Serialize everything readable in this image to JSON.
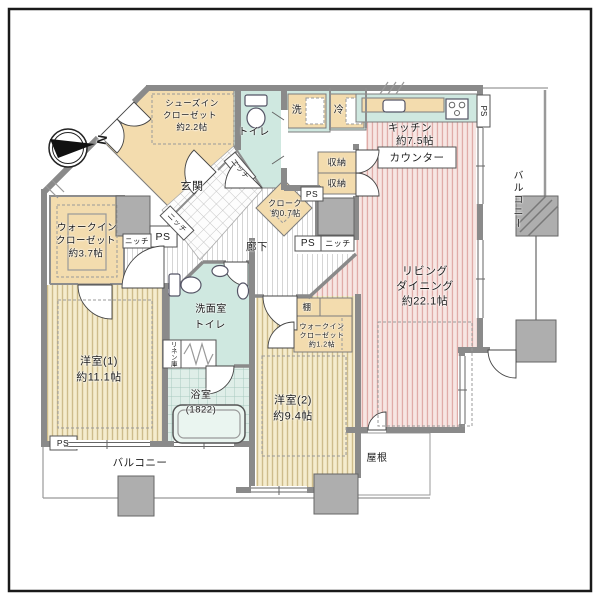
{
  "plan": {
    "compass_label": "N",
    "entrance": {
      "label": "玄関"
    },
    "corridor": {
      "label": "廊下"
    },
    "shoe_closet": {
      "line1": "シューズイン",
      "line2": "クローゼット",
      "line3": "約2.2帖"
    },
    "toilet_top": {
      "label": "トイレ"
    },
    "laundry": {
      "label": "洗"
    },
    "fridge": {
      "label": "冷"
    },
    "kitchen": {
      "line1": "キッチン",
      "line2": "約7.5帖",
      "counter": "カウンター"
    },
    "living_dining": {
      "line1": "リビング",
      "line2": "ダイニング",
      "line3": "約22.1帖"
    },
    "storage": {
      "label": "収納"
    },
    "cloak": {
      "line1": "クローク",
      "line2": "約0.7帖"
    },
    "wic_main": {
      "line1": "ウォークイン",
      "line2": "クローゼット",
      "line3": "約3.7帖"
    },
    "wic_small": {
      "line1": "ウォークイン",
      "line2": "クローゼット",
      "line3": "約1.2帖"
    },
    "bedroom1": {
      "line1": "洋室(1)",
      "line2": "約11.1帖"
    },
    "bedroom2": {
      "line1": "洋室(2)",
      "line2": "約9.4帖"
    },
    "washroom": {
      "line1": "洗面室",
      "line2": "トイレ"
    },
    "linen": {
      "label": "リネン庫"
    },
    "bathroom": {
      "line1": "浴室",
      "line2": "(1822)"
    },
    "shelf": {
      "label": "棚"
    },
    "balcony": {
      "label": "バルコニー"
    },
    "roof": {
      "label": "屋根"
    },
    "niche": {
      "label": "ニッチ"
    },
    "ps": {
      "label": "PS"
    }
  },
  "colors": {
    "floor_pink_bg": "#f7e6e3",
    "floor_pink_stripe": "#e0aca8",
    "room_yellow_bg": "#f5eccd",
    "room_yellow_stripe": "#cebc8b",
    "closet_beige": "#f3dcae",
    "wet_area_teal": "#cfe8e0",
    "bath_tile": "#dfeee8",
    "wall_gray": "#8a8a8a",
    "pillar_gray": "#aeaeae"
  }
}
